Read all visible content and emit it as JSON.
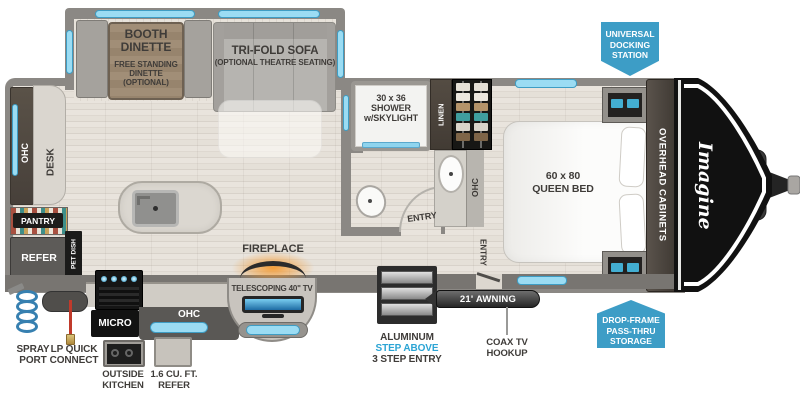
{
  "colors": {
    "badge_blue": "#3d9dc6",
    "window_blue": "#9bdcf3",
    "step_above_blue": "#2ba4d4",
    "fireplace_orange": "#f08c1e",
    "label_dark": "#3f3c39"
  },
  "slideout": {
    "booth_title": "BOOTH\nDINETTE",
    "booth_sub": "FREE STANDING\nDINETTE\n(OPTIONAL)",
    "sofa_title": "TRI-FOLD SOFA",
    "sofa_sub": "(OPTIONAL THEATRE SEATING)"
  },
  "rear": {
    "ohc": "OHC",
    "desk": "DESK",
    "pantry": "PANTRY",
    "refer": "REFER",
    "pet_dish": "PET DISH"
  },
  "bath": {
    "shower": "30 x 36\nSHOWER\nw/SKYLIGHT",
    "entry": "ENTRY",
    "linen": "LINEN",
    "ohc": "OHC"
  },
  "bedroom": {
    "bed": "60 x 80\nQUEEN BED",
    "entry": "ENTRY",
    "overhead_cabinets": "OVERHEAD CABINETS",
    "brand": "Imagine"
  },
  "exterior": {
    "docking_badge": "UNIVERSAL\nDOCKING\nSTATION",
    "storage_badge": "DROP-FRAME\nPASS-THRU\nSTORAGE",
    "spray_port": "SPRAY\nPORT",
    "lp_quick_connect": "LP QUICK\nCONNECT",
    "micro": "MICRO",
    "ohc": "OHC",
    "outside_kitchen": "OUTSIDE\nKITCHEN",
    "outside_refer": "1.6 CU. FT.\nREFER",
    "fireplace": "FIREPLACE",
    "tv": "TELESCOPING 40\" TV",
    "steps_line1": "ALUMINUM",
    "steps_line2": "STEP ABOVE",
    "steps_line3": "3 STEP ENTRY",
    "awning": "21' AWNING",
    "coax": "COAX TV\nHOOKUP"
  }
}
